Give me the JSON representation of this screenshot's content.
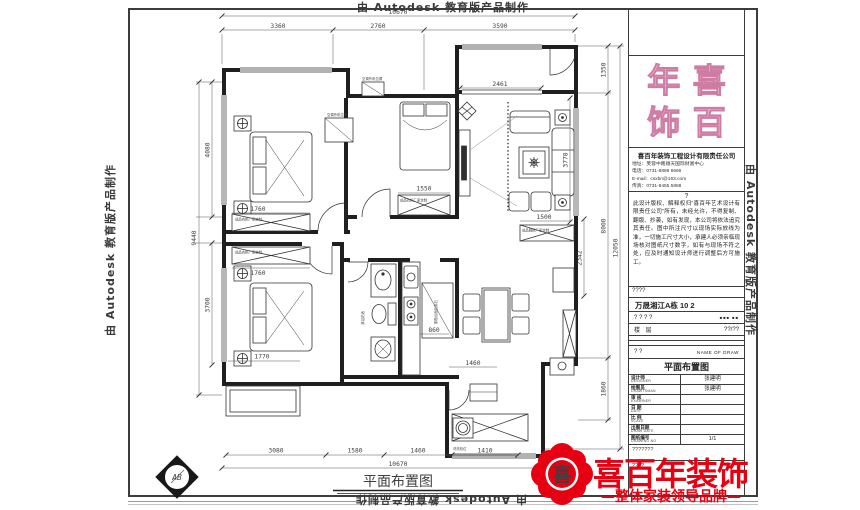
{
  "watermark": {
    "text": "由 Autodesk 教育版产品制作"
  },
  "plan": {
    "title": "平面布置图",
    "compass": "AB",
    "dims": {
      "top_total": "10670",
      "top": [
        "3360",
        "2760",
        "3590"
      ],
      "bottom": [
        "3080",
        "1580",
        "1460",
        "1410"
      ],
      "bottom_total": "10670",
      "left_total": "9440",
      "left": [
        "4080",
        "3700"
      ],
      "right": [
        "1350",
        "8000",
        "1860"
      ],
      "right_total": "12050",
      "inner": {
        "sofa_wall": "3778",
        "hall": "2342",
        "wardrobe1": "1760",
        "wardrobe2": "1760",
        "bay": "1770",
        "wardrobe3": "1550",
        "balcony_win": "2461",
        "shoe": "1500",
        "stove": "860",
        "laundry": "1460"
      }
    },
    "labels": {
      "ac1": "空调外机位置",
      "ac2": "空调外机位置",
      "wardrobe": "成品衣柜厂家定制",
      "shoe_cabinet": "成品鞋柜厂家定制",
      "counter": "橱柜台面石英石",
      "washer": "洗衣机位",
      "bath": "淋浴花洒"
    }
  },
  "titleblock": {
    "logo_chars": [
      "年",
      "喜",
      "饰",
      "百"
    ],
    "company": {
      "name": "喜百年装饰工程设计有限责任公司",
      "lines": [
        "地址：芙蓉中路顺天国际财富中心",
        "电话：0731-8888 6666",
        "E-mail：csxbn@163.com",
        "传真：0731-8455 5888"
      ]
    },
    "notes_mark": "?",
    "notes": "此设计版权、解释权归“喜百年艺术设计有限责任公司”所有，未经允许，不得复制、翻版、抄袭，如有发现，本公司将依法追究其责任。图中所注尺寸以现场实际放线为准，一切施工尺寸大小，承建人必须亲临现场核对图纸尺寸数字，如有与现场不符之处，应及时通知设计师进行调整后方可施工。",
    "row_small": "????",
    "project": "万晟湘江A栋 10 2",
    "row_q": "? ? ? ?",
    "row_q_value": "■■■ ■■",
    "floor_label": "楼 层",
    "floor_value": "??/??",
    "name_label": "? ?",
    "name_en": "NAME OF DRAW",
    "drawing_name": "平面布置图",
    "rows": [
      {
        "cn": "设计师",
        "en": "DESIGNER",
        "value": "张建明"
      },
      {
        "cn": "绘图员",
        "en": "DRAWTSMAN",
        "value": "张建明"
      },
      {
        "cn": "审 核",
        "en": "EXAMINER",
        "value": ""
      },
      {
        "cn": "日 期",
        "en": "DATE",
        "value": ""
      },
      {
        "cn": "比 例",
        "en": "SCALE",
        "value": ""
      },
      {
        "cn": "出图日期",
        "en": "DRAW DATE",
        "value": ""
      },
      {
        "cn": "图纸编号",
        "en": "DRAWING NO",
        "value": "1/1"
      }
    ],
    "bottom_note": "???????",
    "bottom_small": "????"
  },
  "brand": {
    "seal_char": "喜",
    "name": "喜百年装饰",
    "tagline": "—整体家装领导品牌—",
    "red": "#e60012"
  }
}
